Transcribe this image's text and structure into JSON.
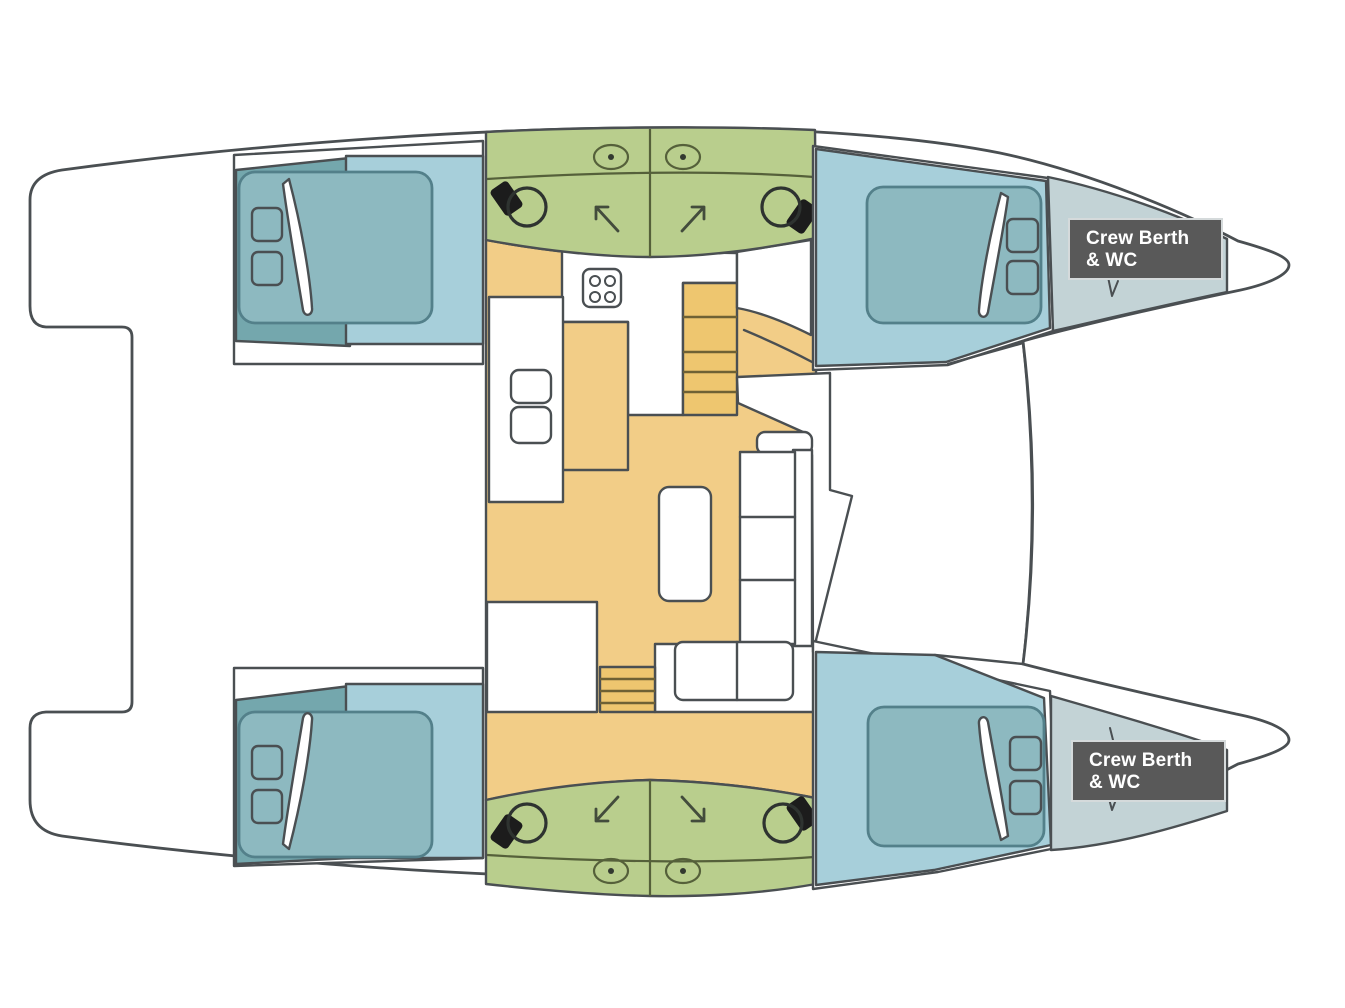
{
  "diagram": {
    "type": "yacht-floor-plan",
    "vessel": "catamaran",
    "orientation": "bow-right"
  },
  "labels": {
    "crew_berth_top": {
      "line1": "Crew Berth",
      "line2": "& WC"
    },
    "crew_berth_bottom": {
      "line1": "Crew Berth",
      "line2": "& WC"
    }
  },
  "colors": {
    "hull_white": "#ffffff",
    "outline": "#4a4f52",
    "salon_yellow": "#f2cd87",
    "head_green": "#b9ce8d",
    "cabin_dark_teal": "#74a7ad",
    "bed_light_blue": "#a7cfda",
    "mattress_teal": "#8db9c0",
    "bow_gray_blue": "#c3d3d6",
    "stairs_tan": "#eec66f",
    "toilet_black": "#1c1c1c",
    "label_bg": "#595959",
    "label_text": "#ffffff",
    "pillow_white": "#ffffff",
    "furniture_white": "#ffffff"
  },
  "icons": {
    "toilet": "toilet-icon",
    "porthole": "porthole-icon",
    "door_swing": "door-swing-arrow-icon",
    "stove": "stove-icon",
    "sink": "sink-icon",
    "stairs": "stairs-icon",
    "bed": "bed-icon",
    "pillow": "pillow-icon",
    "sofa": "sofa-icon",
    "table": "table-icon"
  }
}
